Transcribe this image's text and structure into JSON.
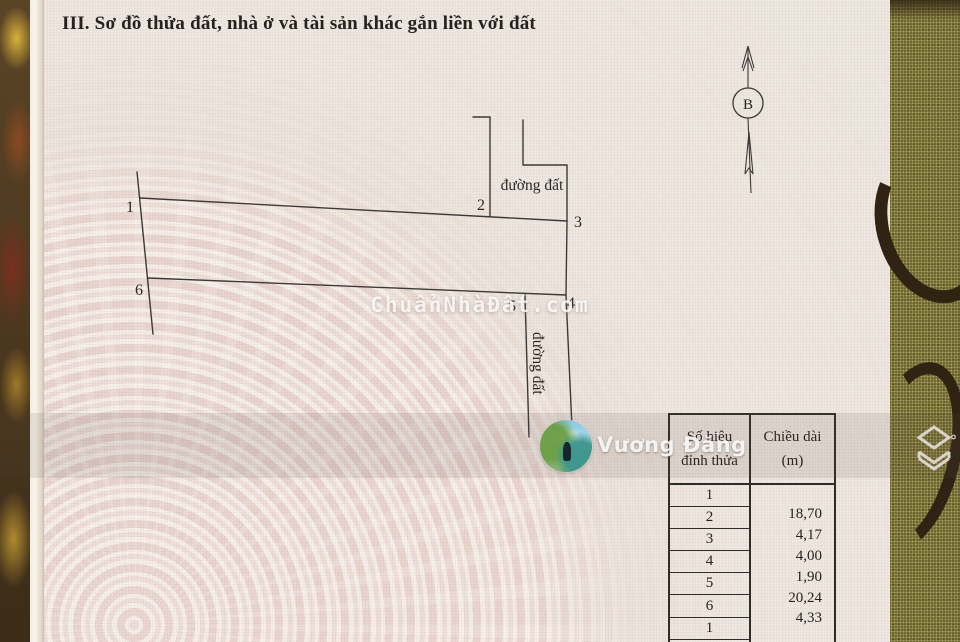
{
  "document": {
    "section_title": "III. Sơ đồ thửa đất, nhà ở và tài sản khác gắn liền với đất"
  },
  "compass": {
    "north_label": "B"
  },
  "diagram": {
    "vertex_labels": [
      "1",
      "2",
      "3",
      "4",
      "5",
      "6"
    ],
    "road_label_top": "đường đất",
    "road_label_side": "đường đất"
  },
  "watermarks": {
    "site": "ChuẩnNhàĐất.com",
    "user": "Vương Đăng"
  },
  "table": {
    "headers": {
      "col1_line1": "Số hiệu",
      "col1_line2": "đỉnh thửa",
      "col2_line1": "Chiều dài",
      "col2_line2": "(m)"
    },
    "vertex_numbers": [
      "1",
      "2",
      "3",
      "4",
      "5",
      "6",
      "1"
    ],
    "lengths_m": [
      "18,70",
      "4,17",
      "4,00",
      "1,90",
      "20,24",
      "4,33"
    ]
  },
  "colors": {
    "paper_pink": "#e7dbd5",
    "fabric_green": "#6a6530",
    "fabric_gold": "#b08a30",
    "ink": "#2f2d2a",
    "watermark_white": "#ffffff"
  }
}
